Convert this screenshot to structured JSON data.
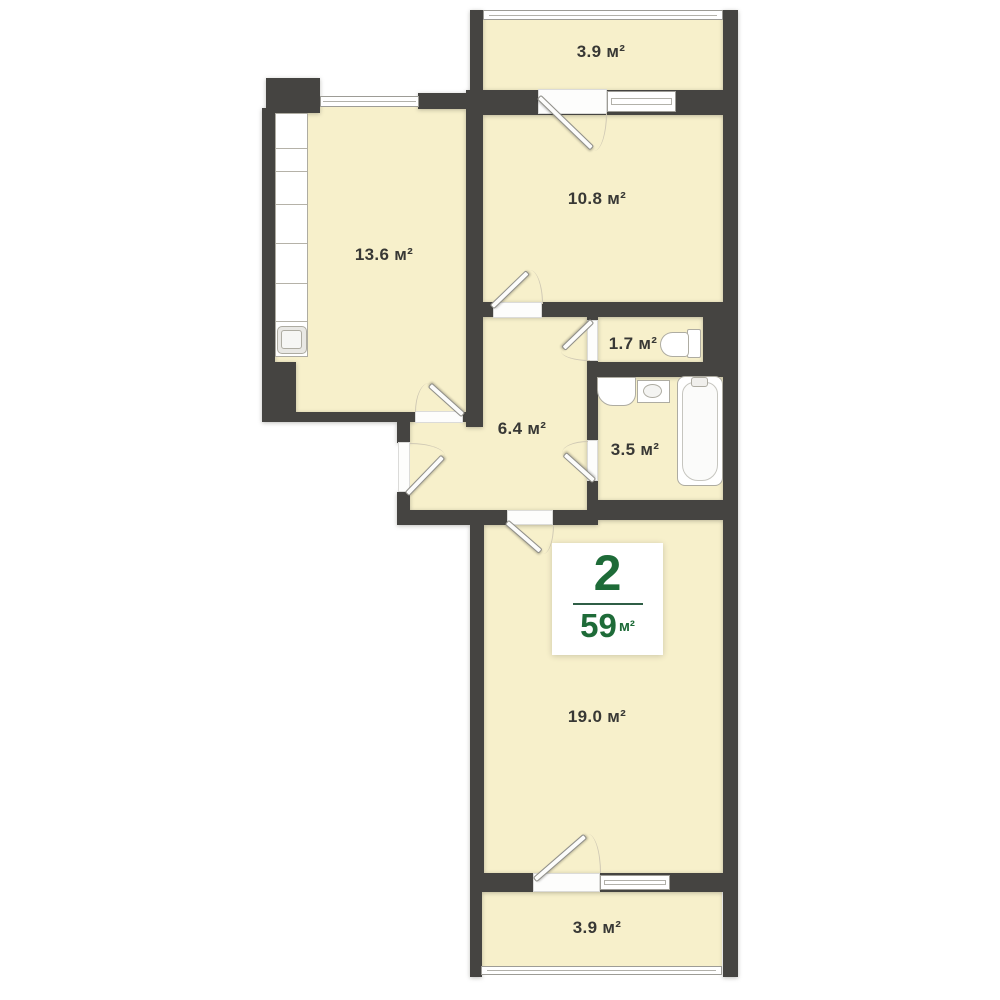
{
  "plan": {
    "title": "apartment floor plan",
    "rooms": [
      {
        "id": "balcony-top",
        "area": "3.9 м²"
      },
      {
        "id": "bedroom",
        "area": "10.8 м²"
      },
      {
        "id": "kitchen",
        "area": "13.6 м²"
      },
      {
        "id": "wc",
        "area": "1.7 м²"
      },
      {
        "id": "hallway",
        "area": "6.4 м²"
      },
      {
        "id": "bathroom",
        "area": "3.5 м²"
      },
      {
        "id": "living-room",
        "area": "19.0 м²"
      },
      {
        "id": "balcony-bottom",
        "area": "3.9 м²"
      }
    ],
    "badge": {
      "rooms_count": "2",
      "total_area": "59",
      "area_unit": "м²"
    },
    "colors": {
      "wall": "#454441",
      "room_fill": "#f7f0cb",
      "accent_green": "#1e6b38",
      "label_text": "#383835"
    }
  }
}
